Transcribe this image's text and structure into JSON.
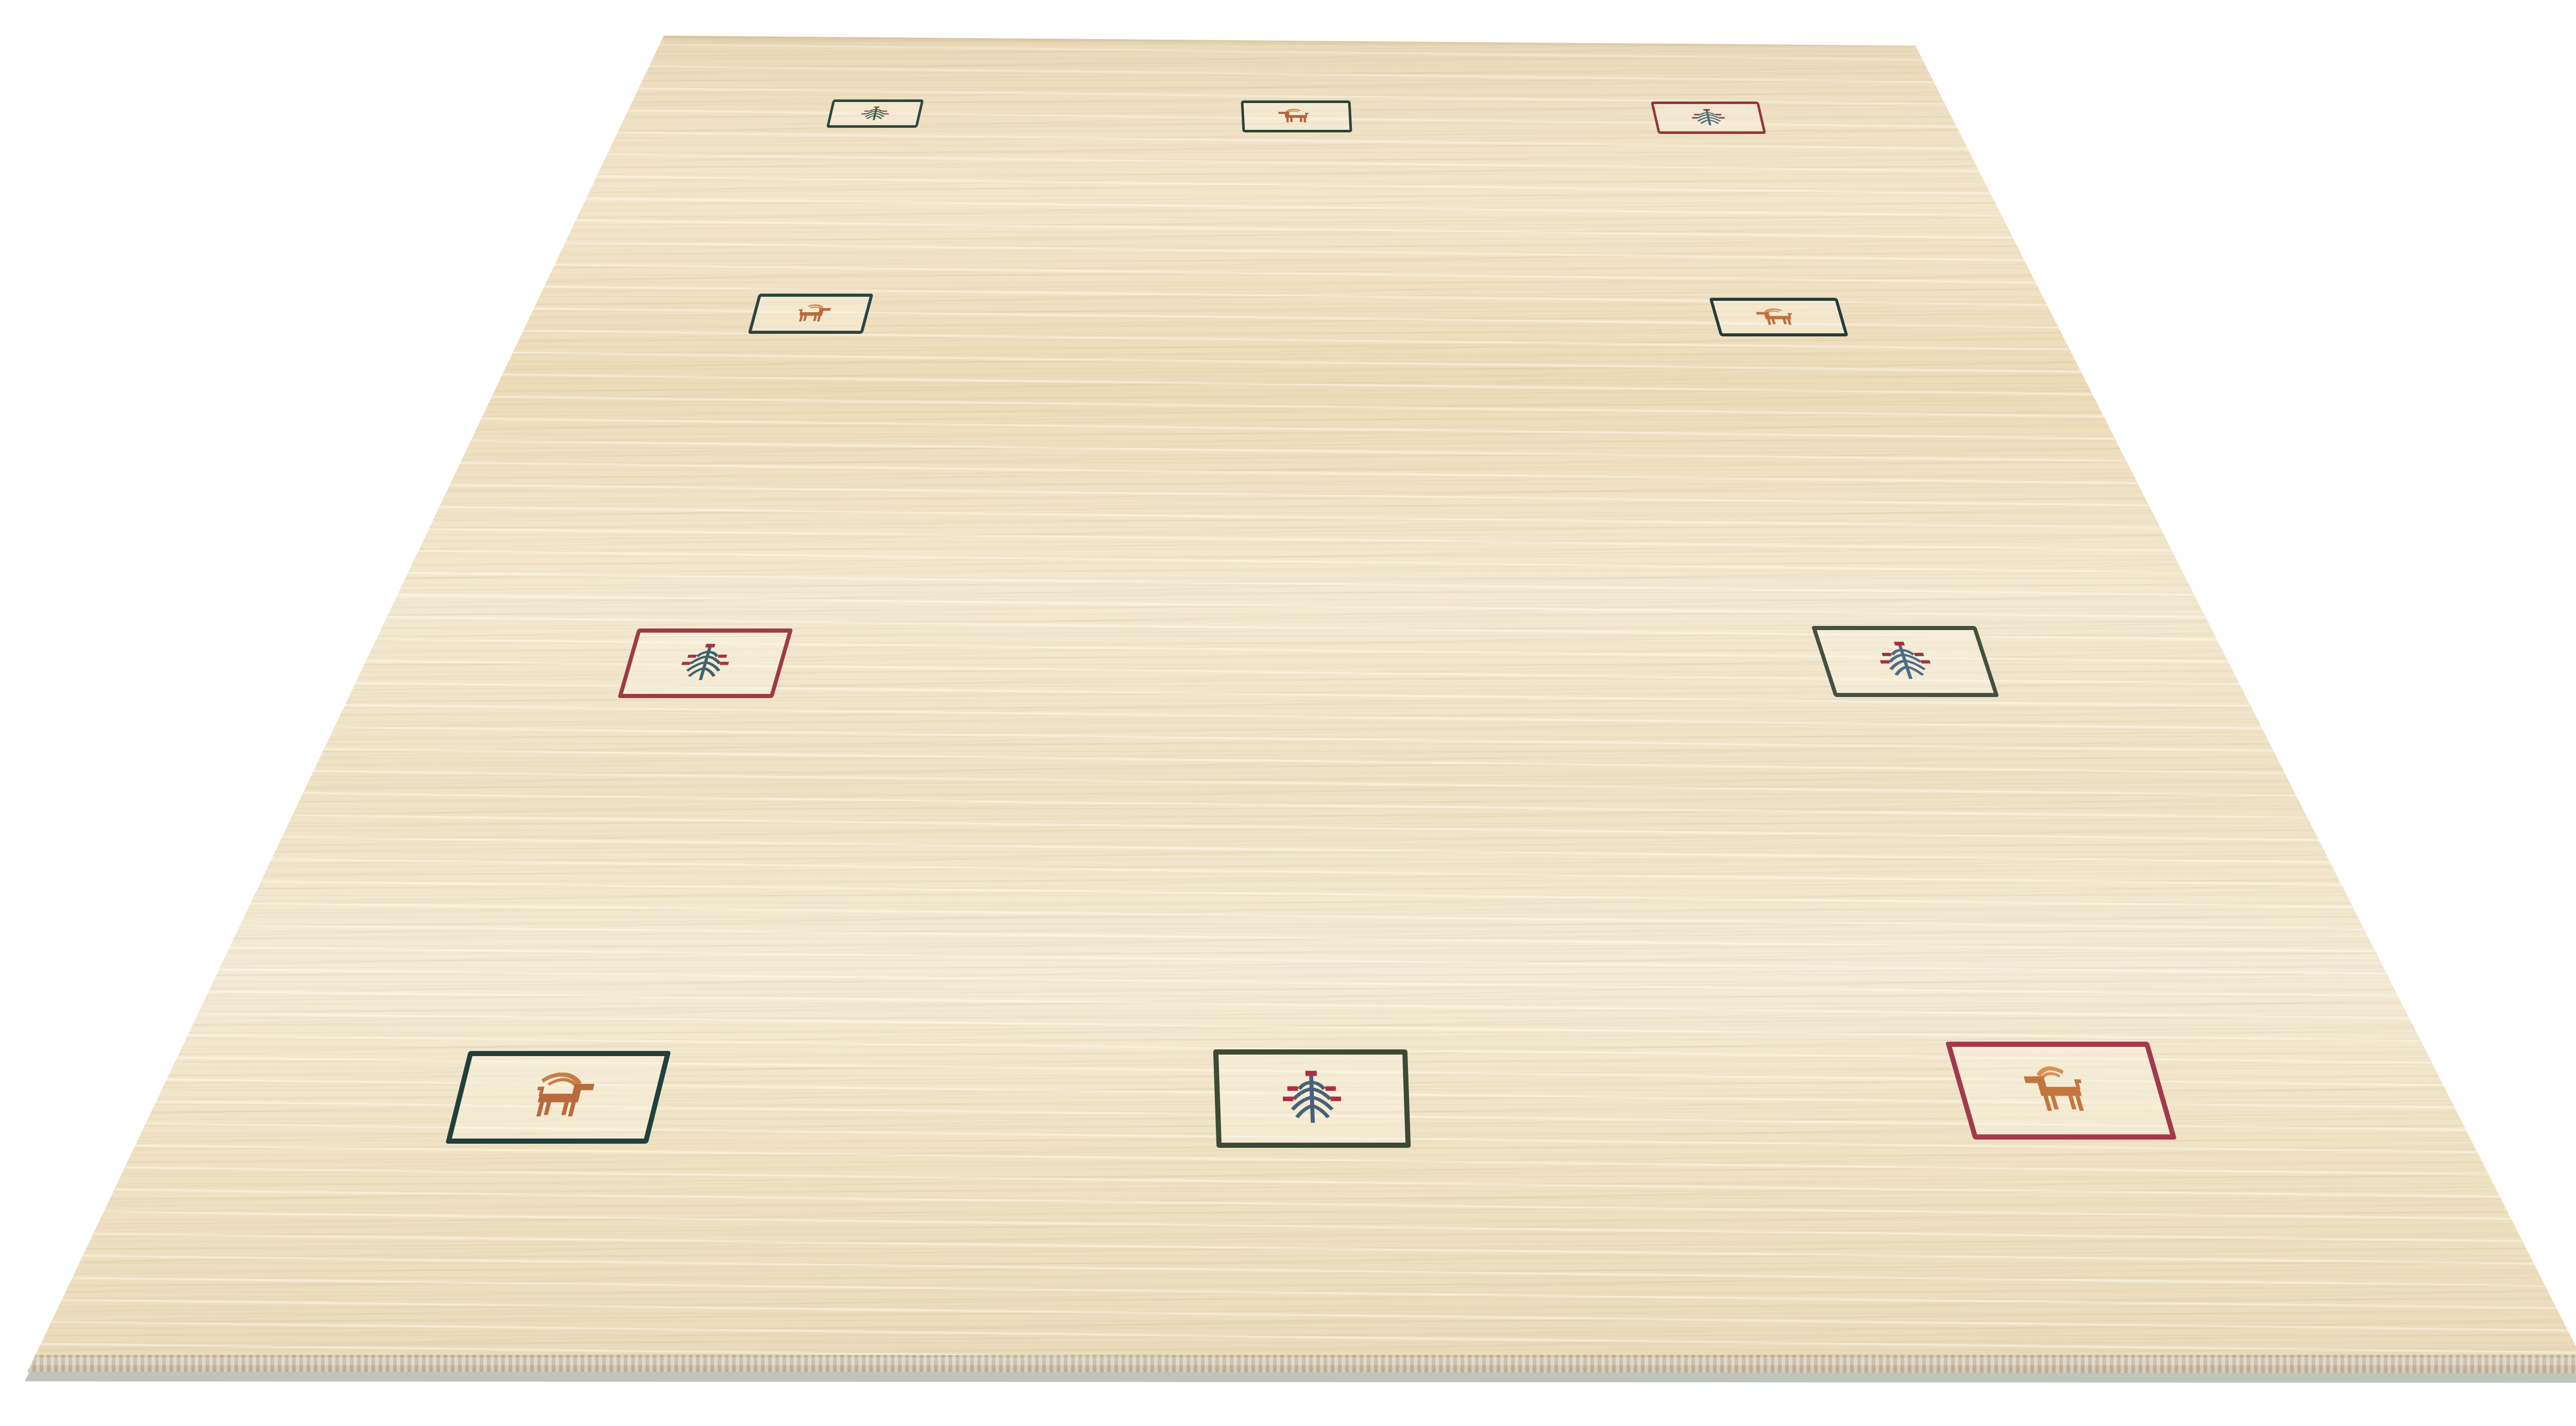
{
  "scene": {
    "background_color": "#ffffff",
    "subject": "cream gabbeh wool rug product photo, angled perspective on white background",
    "rug": {
      "field_base": "#efe2c4",
      "field_light": "#f6eedb",
      "field_warm": "#e7d4ae",
      "selvedge_light": "#d6cab4",
      "selvedge_dark": "#c3b59e",
      "shadow_color": "rgba(139,147,125,0.55)",
      "corners_pct": {
        "top_left": [
          25.4,
          2.5
        ],
        "top_right": [
          73.3,
          3.2
        ],
        "bottom_right": [
          99.1,
          96.3
        ],
        "bottom_left": [
          1.05,
          96.2
        ]
      }
    }
  },
  "motifs": [
    {
      "id": "top-left-tree",
      "type": "tree",
      "border_color": "#2d473d",
      "motif_color": "#3f5a49",
      "accent_color": "#a2464d",
      "left": 31.74,
      "top": 6.97,
      "width": 3.49,
      "height": 1.99,
      "skew": -13,
      "border_px": 5
    },
    {
      "id": "top-center-animal",
      "type": "animal",
      "facing": "left",
      "border_color": "#2c4236",
      "motif_color": "#b5633a",
      "horn_color": "#cd8950",
      "left": 47.52,
      "top": 7.05,
      "width": 4.2,
      "height": 2.24,
      "skew": 3,
      "border_px": 5
    },
    {
      "id": "top-right-tree",
      "type": "tree",
      "border_color": "#96343f",
      "motif_color": "#4b6d77",
      "accent_color": "#8c3842",
      "left": 63.3,
      "top": 7.12,
      "width": 4.14,
      "height": 2.28,
      "skew": 13,
      "border_px": 5
    },
    {
      "id": "middle-left-animal",
      "type": "animal",
      "facing": "right",
      "border_color": "#2c463f",
      "motif_color": "#bb6b3c",
      "horn_color": "#d3905a",
      "left": 28.83,
      "top": 20.59,
      "width": 4.4,
      "height": 2.82,
      "skew": -15,
      "border_px": 6
    },
    {
      "id": "middle-right-animal",
      "type": "animal",
      "facing": "left",
      "border_color": "#263c3a",
      "motif_color": "#c0703d",
      "horn_color": "#d3905a",
      "left": 65.62,
      "top": 20.88,
      "width": 4.91,
      "height": 2.71,
      "skew": 16,
      "border_px": 6
    },
    {
      "id": "lower-left-tree",
      "type": "tree",
      "border_color": "#9d3b45",
      "motif_color": "#3f626b",
      "accent_color": "#9e3742",
      "left": 24.01,
      "top": 44.08,
      "width": 5.95,
      "height": 4.88,
      "skew": -16,
      "border_px": 8
    },
    {
      "id": "lower-right-tree",
      "type": "tree",
      "border_color": "#44513f",
      "motif_color": "#4e6d86",
      "accent_color": "#a12f3d",
      "left": 69.76,
      "top": 43.9,
      "width": 6.31,
      "height": 4.99,
      "skew": 18,
      "border_px": 8
    },
    {
      "id": "bottom-left-goat",
      "type": "animal",
      "facing": "right",
      "long_horns": true,
      "border_color": "#21403e",
      "motif_color": "#b96a3e",
      "horn_color": "#c97c46",
      "left": 17.49,
      "top": 73.7,
      "width": 7.75,
      "height": 6.5,
      "skew": -14,
      "border_px": 10
    },
    {
      "id": "bottom-center-tree",
      "type": "tree",
      "border_color": "#3e4a33",
      "motif_color": "#47617a",
      "accent_color": "#ab2f3f",
      "left": 46.49,
      "top": 73.59,
      "width": 7.43,
      "height": 6.9,
      "skew": 2,
      "border_px": 10
    },
    {
      "id": "bottom-right-animal",
      "type": "animal",
      "facing": "left",
      "border_color": "#a23a4b",
      "motif_color": "#c4763f",
      "horn_color": "#d79154",
      "left": 74.98,
      "top": 73.05,
      "width": 7.79,
      "height": 6.86,
      "skew": 16,
      "border_px": 10
    }
  ]
}
